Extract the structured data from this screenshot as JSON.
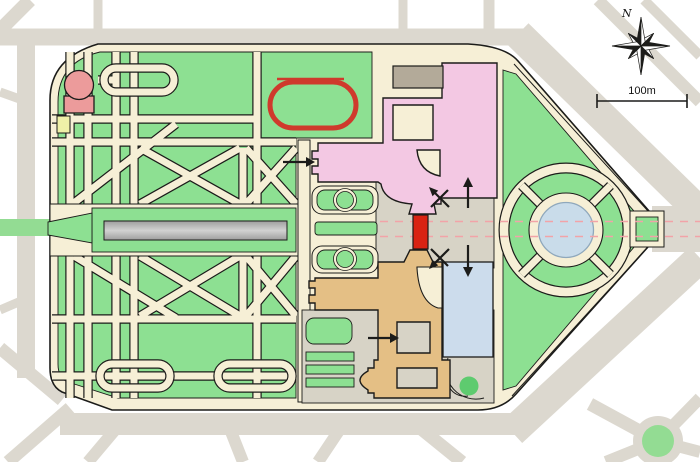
{
  "map": {
    "type": "palace-park-site-plan",
    "compass_label": "N",
    "scale_label": "100m"
  },
  "palette": {
    "background": "#ffffff",
    "street": "#dcd8cf",
    "cream": "#f6efd6",
    "lawn": "#8de092",
    "median": "#93dc93",
    "ink": "#1c1c1a",
    "pink": "#f3c8e3",
    "salmon": "#ec9b9b",
    "tan": "#e4bf85",
    "roof": "#b3aa99",
    "blue": "#ccdcec",
    "pond": "#c9dcea",
    "pond-edge": "#8fa8bc",
    "canal-a": "#9e9e9e",
    "canal-b": "#d2d2d2",
    "plaza": "#d7d3c6",
    "gate-red": "#d92313",
    "track-red": "#cf3a2c",
    "dash-pink": "#f2a3a8",
    "yellow": "#eef0a8",
    "tree": "#5ecb6f"
  }
}
